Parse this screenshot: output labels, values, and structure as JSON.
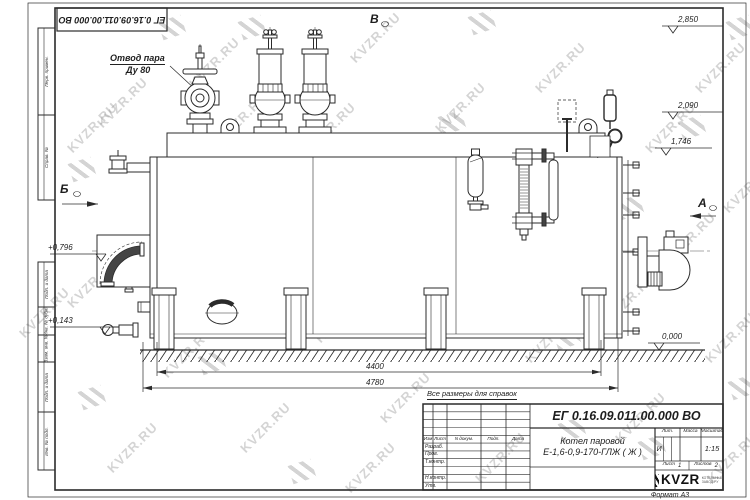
{
  "watermark": {
    "text": "KVZR.RU"
  },
  "frame": {
    "top_left_number": "ЕГ 0.16.09.011.00.000  ВО",
    "left_columns": [
      "Перв. примен.",
      "Справ. №",
      "Подп. и дата",
      "Инв. № дубл.",
      "Взам. инв. №",
      "Подп. и дата",
      "Инв. № подл."
    ],
    "format_note": "Формат А3"
  },
  "drawing": {
    "labels": {
      "steam_outlet_line1": "Отвод пара",
      "steam_outlet_line2": "Ду 80"
    },
    "view_markers": [
      "Б",
      "В",
      "А"
    ],
    "levels_right": [
      "2,850",
      "2,090",
      "1,746"
    ],
    "level_zero": "0,000",
    "levels_left": [
      "+0,796",
      "+0,143"
    ],
    "dimensions": [
      "4400",
      "4780"
    ]
  },
  "title_block": {
    "reference_note": "Все размеры для справок",
    "doc_number": "ЕГ 0.16.09.011.00.000  ВО",
    "title_line1": "Котел паровой",
    "title_line2": "Е-1,6-0,9-170-ГЛЖ ( Ж )",
    "header_cells": [
      "Изм",
      "Лист",
      "N докум.",
      "Подп.",
      "Дата"
    ],
    "row_labels": [
      "Разраб.",
      "Пров.",
      "Т.контр.",
      "Н.контр.",
      "Утв."
    ],
    "lit_label": "Лит.",
    "lit_value": "И",
    "mass_label": "Масса",
    "scale_label": "Масштаб",
    "scale_value": "1:15",
    "sheet_label": "Лист",
    "sheet_value": "1",
    "sheets_label": "Листов",
    "sheets_value": "2",
    "logo_text": "KVZR",
    "logo_sub1": "КОТЕЛЬНЫЙ",
    "logo_sub2": "ЗАВОД.РУ"
  }
}
